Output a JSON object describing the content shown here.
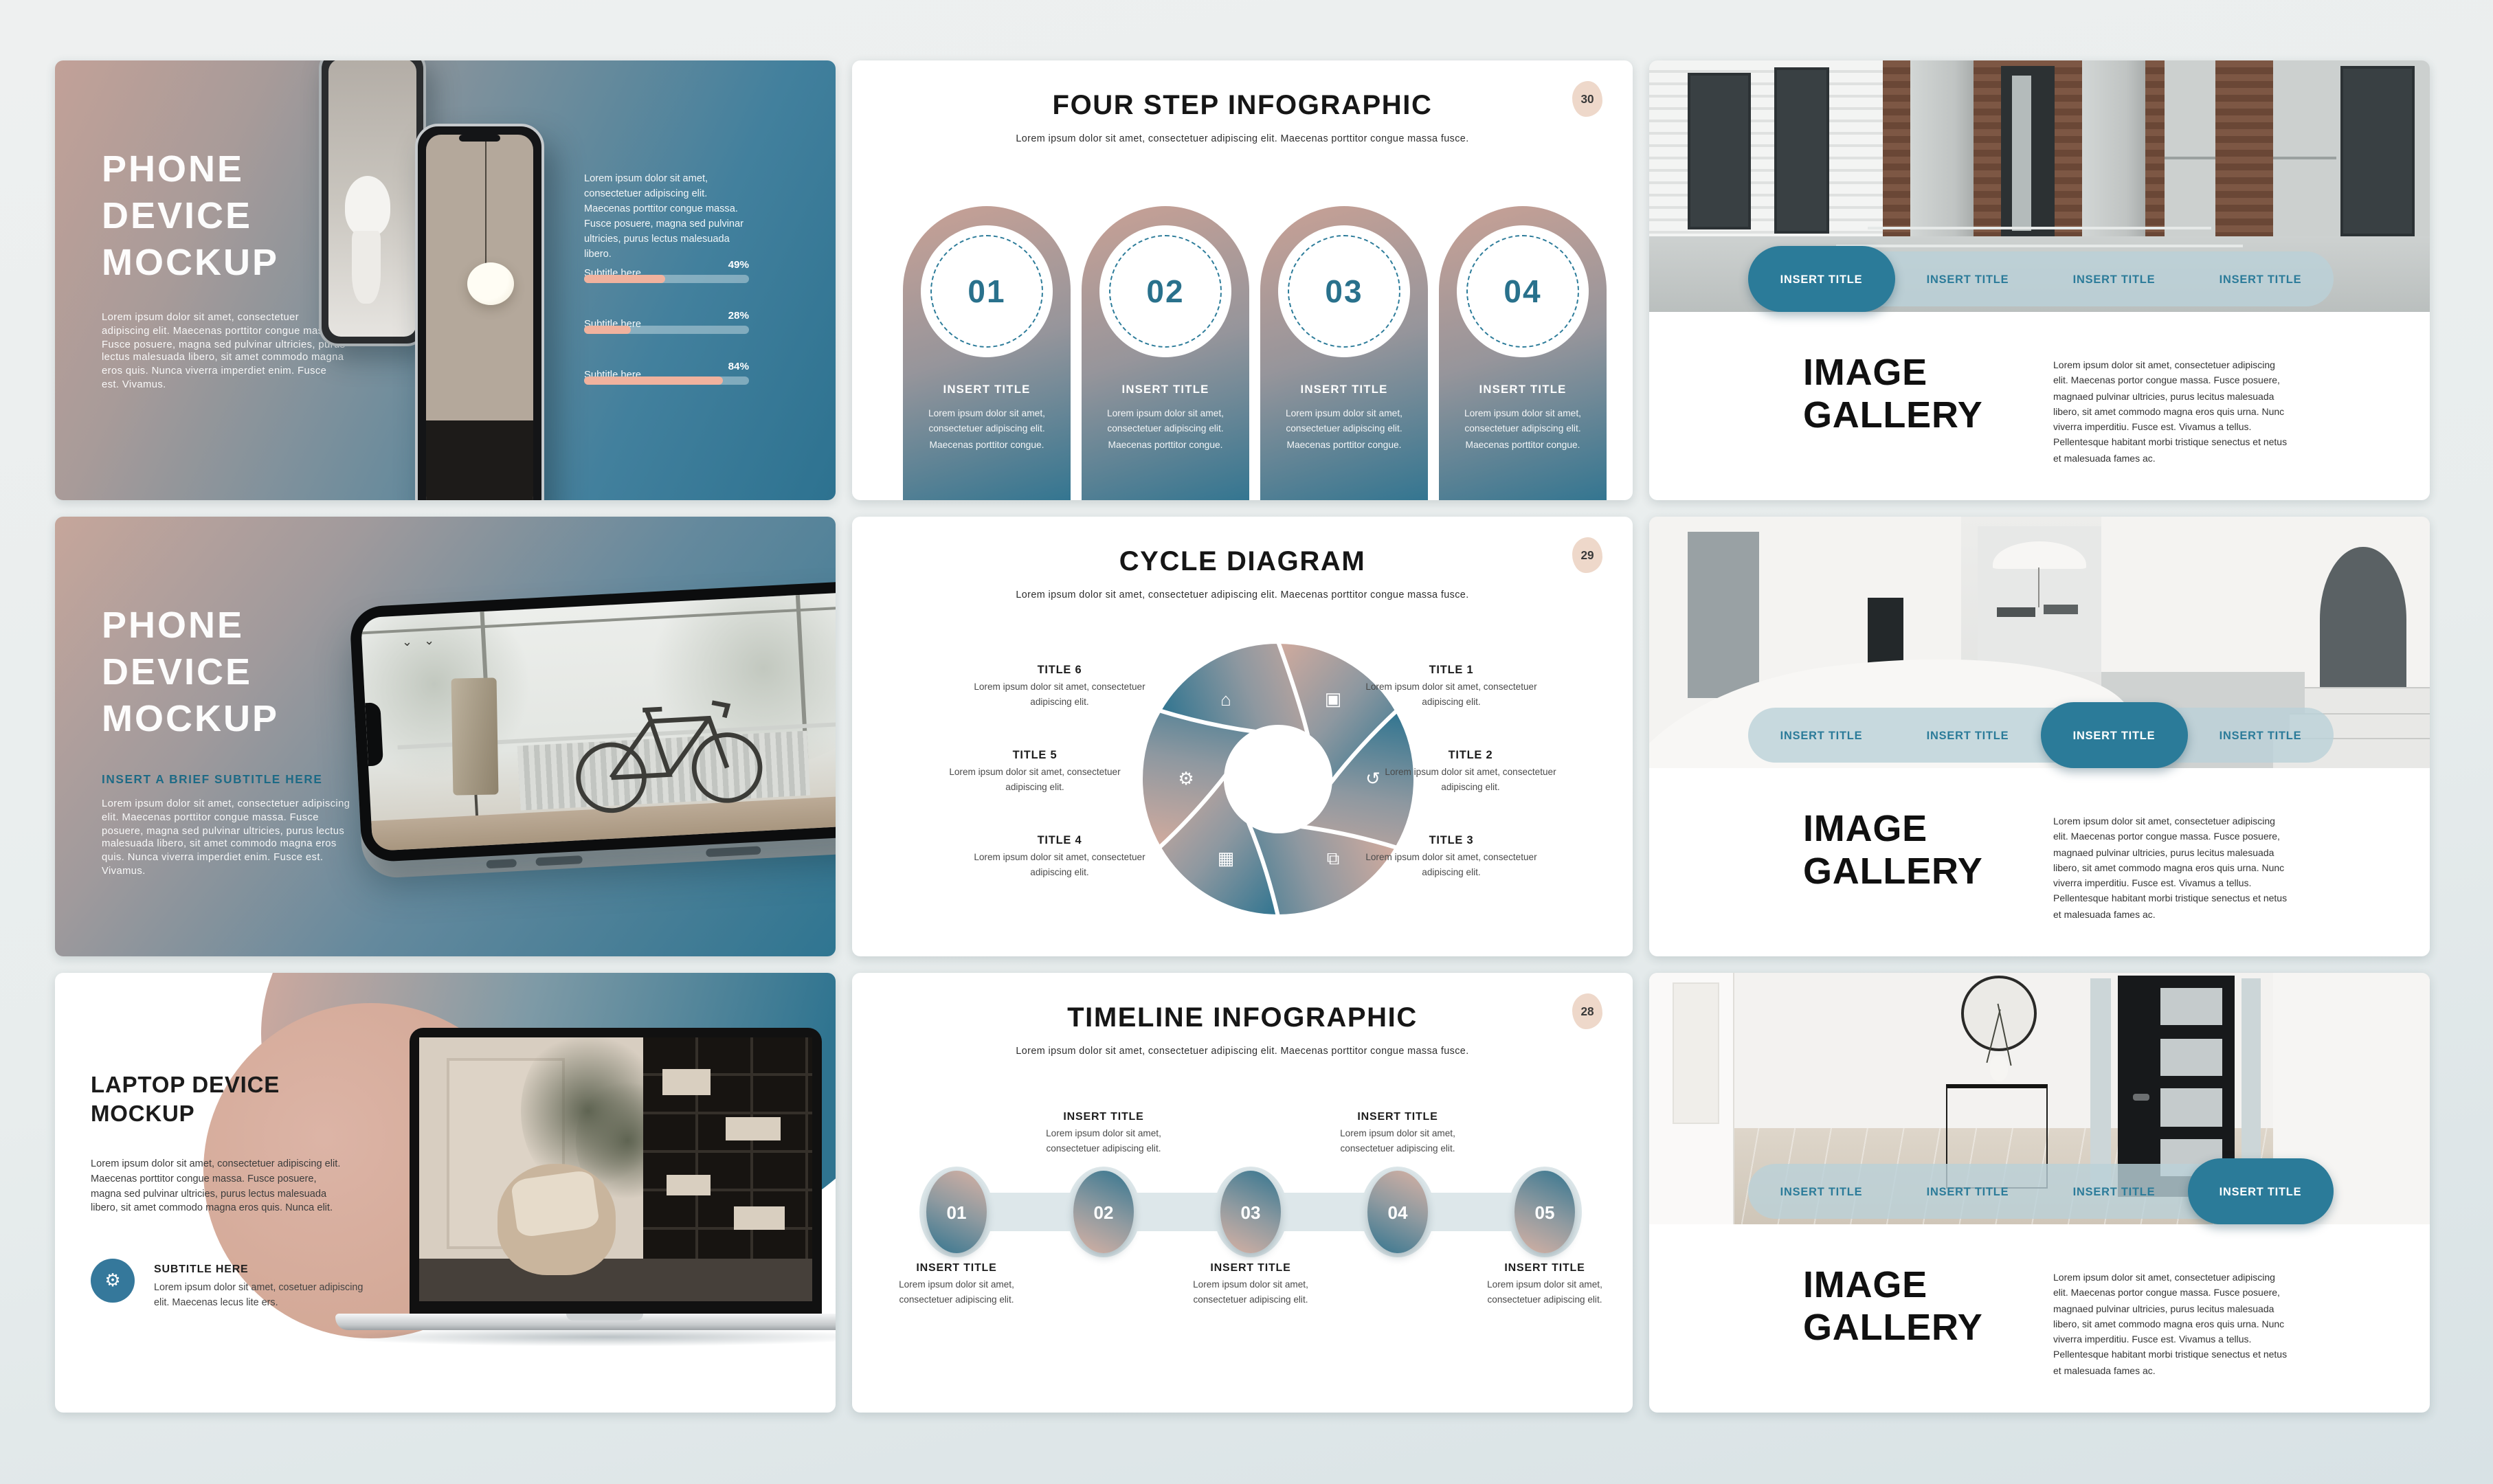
{
  "colors": {
    "accent": "#2b7b99",
    "salmon": "#f0b29e",
    "bubble_bg": "#eed8ca"
  },
  "slide_phone_mockup_1": {
    "title_lines": [
      "PHONE",
      "DEVICE",
      "MOCKUP"
    ],
    "body": "Lorem ipsum dolor sit amet, consectetuer adipiscing elit. Maecenas porttitor congue massa. Fusce posuere, magna sed pulvinar ultricies, purus lectus malesuada libero, sit amet commodo magna eros quis. Nunca viverra imperdiet enim. Fusce est. Vivamus.",
    "side_text": "Lorem ipsum dolor sit amet, consectetuer adipiscing elit. Maecenas porttitor congue massa. Fusce posuere, magna sed pulvinar ultricies, purus lectus malesuada libero.",
    "progress": [
      {
        "label": "Subtitle here",
        "value": "49%",
        "pct": 49
      },
      {
        "label": "Subtitle here",
        "value": "28%",
        "pct": 28
      },
      {
        "label": "Subtitle here",
        "value": "84%",
        "pct": 84
      }
    ]
  },
  "slide_four_step": {
    "title": "FOUR STEP INFOGRAPHIC",
    "subtitle": "Lorem ipsum dolor sit amet, consectetuer adipiscing elit. Maecenas porttitor congue massa fusce.",
    "page_number": "30",
    "steps": [
      {
        "num": "01",
        "title": "INSERT TITLE",
        "body": "Lorem ipsum dolor sit amet, consectetuer adipiscing elit. Maecenas porttitor congue."
      },
      {
        "num": "02",
        "title": "INSERT TITLE",
        "body": "Lorem ipsum dolor sit amet, consectetuer adipiscing elit. Maecenas porttitor congue."
      },
      {
        "num": "03",
        "title": "INSERT TITLE",
        "body": "Lorem ipsum dolor sit amet, consectetuer adipiscing elit. Maecenas porttitor congue."
      },
      {
        "num": "04",
        "title": "INSERT TITLE",
        "body": "Lorem ipsum dolor sit amet, consectetuer adipiscing elit. Maecenas porttitor congue."
      }
    ]
  },
  "slide_gallery_top": {
    "tabs": [
      {
        "label": "INSERT TITLE",
        "active": true
      },
      {
        "label": "INSERT TITLE",
        "active": false
      },
      {
        "label": "INSERT TITLE",
        "active": false
      },
      {
        "label": "INSERT TITLE",
        "active": false
      }
    ],
    "title_lines": [
      "IMAGE",
      "GALLERY"
    ],
    "body": "Lorem ipsum dolor sit amet, consectetuer adipiscing elit. Maecenas portor congue massa. Fusce posuere, magnaed pulvinar ultricies, purus lecitus malesuada libero, sit amet commodo magna eros quis urna. Nunc viverra imperditiu. Fusce est. Vivamus a tellus. Pellentesque habitant morbi tristique senectus et netus et malesuada fames ac."
  },
  "slide_phone_mockup_2": {
    "title_lines": [
      "PHONE",
      "DEVICE",
      "MOCKUP"
    ],
    "subtitle": "INSERT A BRIEF SUBTITLE HERE",
    "body": "Lorem ipsum dolor sit amet, consectetuer adipiscing elit. Maecenas porttitor congue massa. Fusce posuere, magna sed pulvinar ultricies, purus lectus malesuada libero, sit amet commodo magna eros quis. Nunca viverra imperdiet enim. Fusce est. Vivamus."
  },
  "slide_cycle": {
    "title": "CYCLE DIAGRAM",
    "subtitle": "Lorem ipsum dolor sit amet, consectetuer adipiscing elit. Maecenas porttitor congue massa fusce.",
    "page_number": "29",
    "items": [
      {
        "title": "TITLE 1",
        "body": "Lorem ipsum dolor sit amet, consectetuer adipiscing elit.",
        "icon": "cubes-icon",
        "glyph": "▣"
      },
      {
        "title": "TITLE 2",
        "body": "Lorem ipsum dolor sit amet, consectetuer adipiscing elit.",
        "icon": "history-clock-icon",
        "glyph": "↺"
      },
      {
        "title": "TITLE 3",
        "body": "Lorem ipsum dolor sit amet, consectetuer adipiscing elit.",
        "icon": "map-icon",
        "glyph": "⧉"
      },
      {
        "title": "TITLE 4",
        "body": "Lorem ipsum dolor sit amet, consectetuer adipiscing elit.",
        "icon": "calendar-icon",
        "glyph": "▦"
      },
      {
        "title": "TITLE 5",
        "body": "Lorem ipsum dolor sit amet, consectetuer adipiscing elit.",
        "icon": "gear-icon",
        "glyph": "⚙"
      },
      {
        "title": "TITLE 6",
        "body": "Lorem ipsum dolor sit amet, consectetuer adipiscing elit.",
        "icon": "factory-icon",
        "glyph": "⌂"
      }
    ]
  },
  "slide_gallery_mid": {
    "tabs": [
      {
        "label": "INSERT TITLE",
        "active": false
      },
      {
        "label": "INSERT TITLE",
        "active": false
      },
      {
        "label": "INSERT TITLE",
        "active": true
      },
      {
        "label": "INSERT TITLE",
        "active": false
      }
    ],
    "title_lines": [
      "IMAGE",
      "GALLERY"
    ],
    "body": "Lorem ipsum dolor sit amet, consectetuer adipiscing elit. Maecenas portor congue massa. Fusce posuere, magnaed pulvinar ultricies, purus lecitus malesuada libero, sit amet commodo magna eros quis urna. Nunc viverra imperditiu. Fusce est. Vivamus a tellus. Pellentesque habitant morbi tristique senectus et netus et malesuada fames ac."
  },
  "slide_laptop": {
    "title_lines": [
      "LAPTOP DEVICE",
      "MOCKUP"
    ],
    "body": "Lorem ipsum dolor sit amet, consectetuer adipiscing elit. Maecenas porttitor congue massa. Fusce posuere, magna sed pulvinar ultricies, purus lectus malesuada libero, sit amet commodo magna eros quis. Nunca elit.",
    "callout": {
      "title": "SUBTITLE HERE",
      "body": "Lorem ipsum dolor sit amet, cosetuer adipiscing elit. Maecenas lecus lite ers.",
      "icon_glyph": "⚙"
    }
  },
  "slide_timeline": {
    "title": "TIMELINE INFOGRAPHIC",
    "subtitle": "Lorem ipsum dolor sit amet, consectetuer adipiscing elit. Maecenas porttitor congue massa fusce.",
    "page_number": "28",
    "steps": [
      {
        "num": "01",
        "title": "INSERT TITLE",
        "body": "Lorem ipsum dolor sit amet, consectetuer adipiscing elit.",
        "label_position": "below"
      },
      {
        "num": "02",
        "title": "INSERT TITLE",
        "body": "Lorem ipsum dolor sit amet, consectetuer adipiscing elit.",
        "label_position": "above"
      },
      {
        "num": "03",
        "title": "INSERT TITLE",
        "body": "Lorem ipsum dolor sit amet, consectetuer adipiscing elit.",
        "label_position": "below"
      },
      {
        "num": "04",
        "title": "INSERT TITLE",
        "body": "Lorem ipsum dolor sit amet, consectetuer adipiscing elit.",
        "label_position": "above"
      },
      {
        "num": "05",
        "title": "INSERT TITLE",
        "body": "Lorem ipsum dolor sit amet, consectetuer adipiscing elit.",
        "label_position": "below"
      }
    ]
  },
  "slide_gallery_bottom": {
    "tabs": [
      {
        "label": "INSERT TITLE",
        "active": false
      },
      {
        "label": "INSERT TITLE",
        "active": false
      },
      {
        "label": "INSERT TITLE",
        "active": false
      },
      {
        "label": "INSERT TITLE",
        "active": true
      }
    ],
    "title_lines": [
      "IMAGE",
      "GALLERY"
    ],
    "body": "Lorem ipsum dolor sit amet, consectetuer adipiscing elit. Maecenas portor congue massa. Fusce posuere, magnaed pulvinar ultricies, purus lecitus malesuada libero, sit amet commodo magna eros quis urna. Nunc viverra imperditiu. Fusce est. Vivamus a tellus. Pellentesque habitant morbi tristique senectus et netus et malesuada fames ac."
  }
}
